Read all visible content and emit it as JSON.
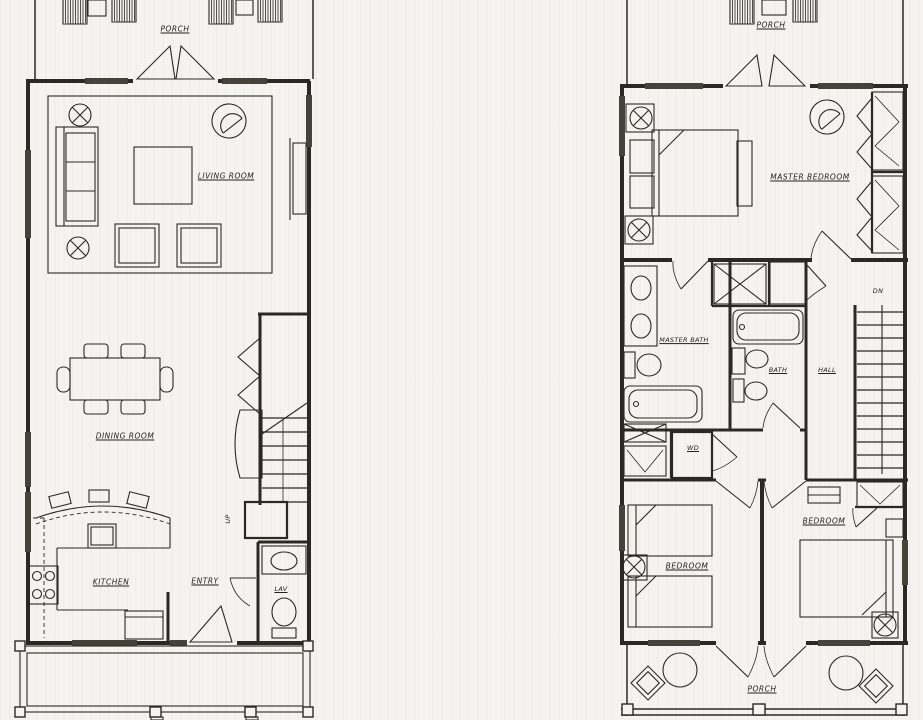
{
  "colors": {
    "paper": "#f4f3ef",
    "ink": "#2b2923"
  },
  "first_floor": {
    "porch": "PORCH",
    "living_room": "LIVING ROOM",
    "dining_room": "DINING ROOM",
    "kitchen": "KITCHEN",
    "entry": "ENTRY",
    "lav": "LAV",
    "up": "UP"
  },
  "second_floor": {
    "porch_top": "PORCH",
    "master_bedroom": "MASTER BEDROOM",
    "master_bath": "MASTER BATH",
    "bath": "BATH",
    "hall": "HALL",
    "dn": "DN",
    "wd": "WD",
    "bedroom_left": "BEDROOM",
    "bedroom_right": "BEDROOM",
    "porch_bottom": "PORCH"
  }
}
